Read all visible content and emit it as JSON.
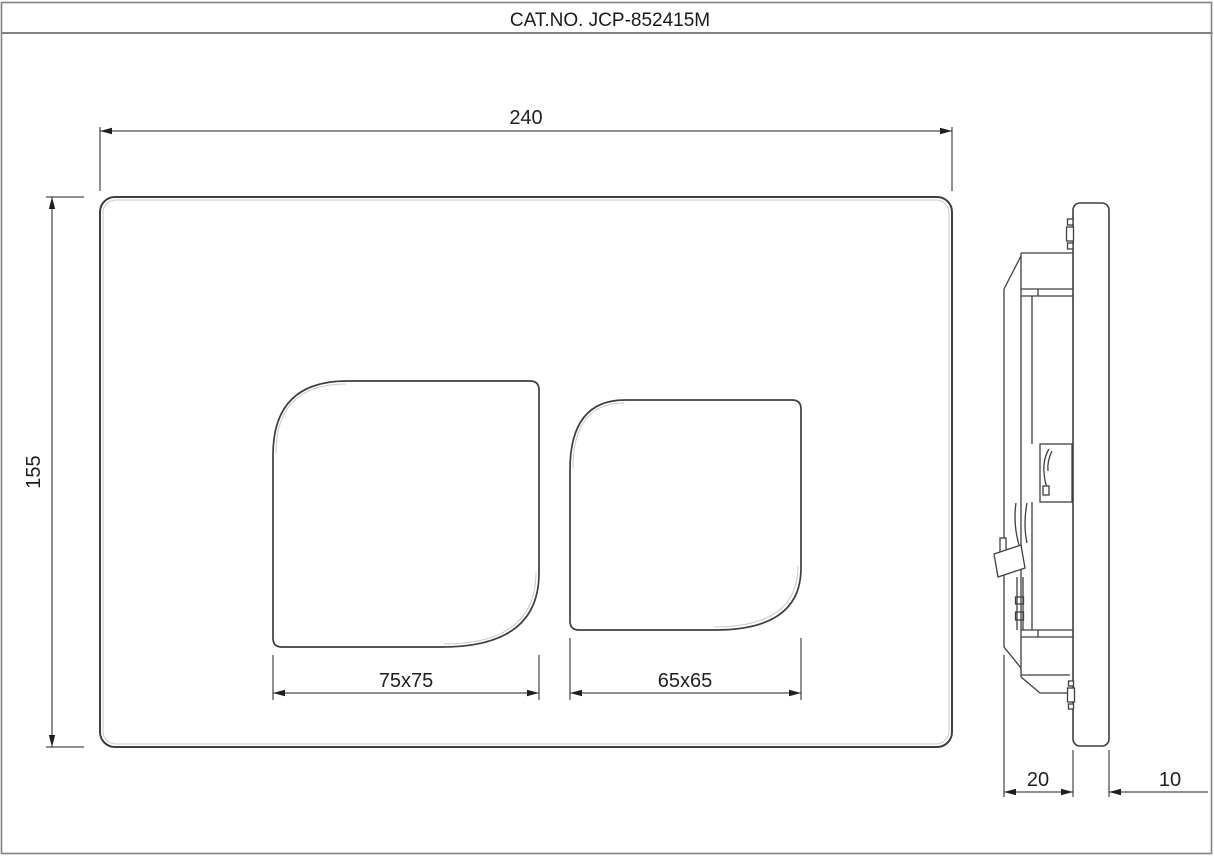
{
  "title_block": {
    "catalog_number": "CAT.NO. JCP-852415M"
  },
  "dimensions": {
    "plate_width": "240",
    "plate_height": "155",
    "large_button": "75x75",
    "small_button": "65x65",
    "frame_depth": "20",
    "plate_thickness": "10"
  },
  "colors": {
    "line": "#3f3f3f",
    "dim": "#1f1f1f",
    "border": "#828282",
    "highlight": "#c9c9c9",
    "background": "#ffffff"
  }
}
